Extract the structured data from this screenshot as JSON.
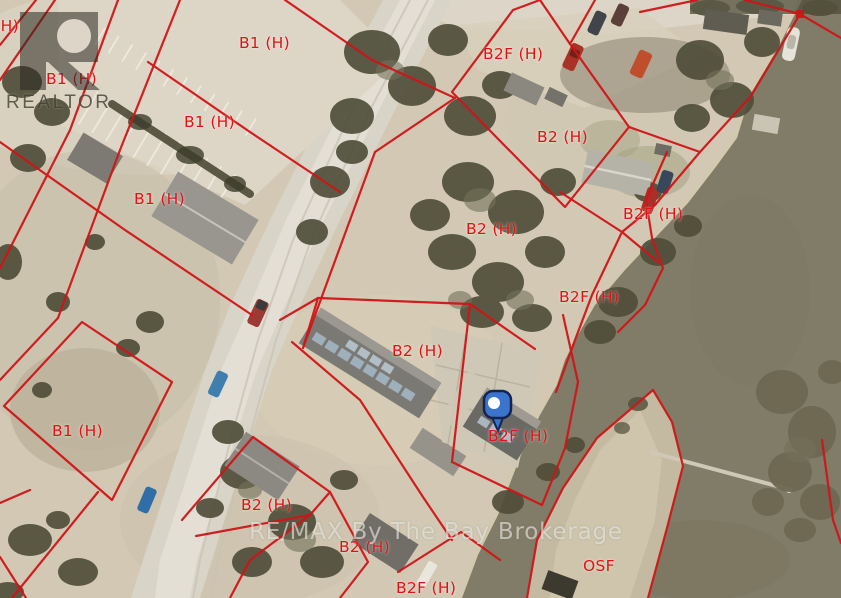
{
  "map": {
    "description": "Aerial parcel map with zoning overlay",
    "zone_labels": [
      {
        "text": "B1 (H)",
        "x": -32,
        "y": 17
      },
      {
        "text": "B1 (H)",
        "x": 46,
        "y": 70
      },
      {
        "text": "B1 (H)",
        "x": 239,
        "y": 34
      },
      {
        "text": "B1 (H)",
        "x": 184,
        "y": 113
      },
      {
        "text": "B1 (H)",
        "x": 134,
        "y": 190
      },
      {
        "text": "B1 (H)",
        "x": 52,
        "y": 422
      },
      {
        "text": "B2F (H)",
        "x": 483,
        "y": 45
      },
      {
        "text": "B2 (H)",
        "x": 537,
        "y": 128
      },
      {
        "text": "B2F (H)",
        "x": 623,
        "y": 205
      },
      {
        "text": "B2 (H)",
        "x": 466,
        "y": 220
      },
      {
        "text": "B2F (H)",
        "x": 559,
        "y": 288
      },
      {
        "text": "B2 (H)",
        "x": 392,
        "y": 342
      },
      {
        "text": "B2F (H)",
        "x": 488,
        "y": 427
      },
      {
        "text": "B2 (H)",
        "x": 241,
        "y": 496
      },
      {
        "text": "B2 (H)",
        "x": 339,
        "y": 538
      },
      {
        "text": "B2F (H)",
        "x": 396,
        "y": 579
      },
      {
        "text": "OSF",
        "x": 583,
        "y": 557
      }
    ],
    "colors": {
      "parcel_line": "#d01518",
      "zone_label": "#e01212",
      "water": "#817c67",
      "land": "#d2c8b4",
      "pin": "#3a74cc"
    }
  },
  "marker": {
    "name": "property-location-pin"
  },
  "watermarks": {
    "realtor": "REALTOR",
    "brokerage": "RE/MAX By The Bay Brokerage"
  }
}
